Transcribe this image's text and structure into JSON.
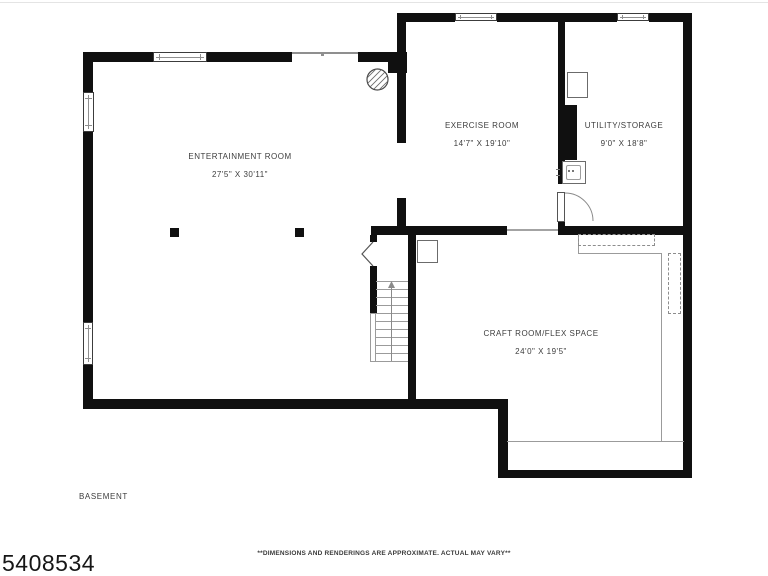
{
  "floor_plan": {
    "title": "BASEMENT",
    "listing_number": "5408534",
    "disclaimer": "**DIMENSIONS AND RENDERINGS ARE APPROXIMATE. ACTUAL MAY VARY**",
    "rooms": [
      {
        "name": "ENTERTAINMENT ROOM",
        "dimensions": "27'5\" X 30'11\""
      },
      {
        "name": "EXERCISE ROOM",
        "dimensions": "14'7\" X 19'10\""
      },
      {
        "name": "UTILITY/STORAGE",
        "dimensions": "9'0\" X 18'8\""
      },
      {
        "name": "CRAFT ROOM/FLEX SPACE",
        "dimensions": "24'0\" X 19'5\""
      }
    ],
    "symbols": {
      "chimney": "hatched-circle",
      "stairs": "treads-with-up-arrow",
      "door": "quarter-arc-swing",
      "open-door": "chevron-leaf",
      "window": "double-line-window",
      "support_columns": 2
    },
    "colors": {
      "wall": "#101010",
      "label_text": "#3d3d3d",
      "thin_line": "#9b9b9b",
      "background": "#ffffff"
    }
  }
}
